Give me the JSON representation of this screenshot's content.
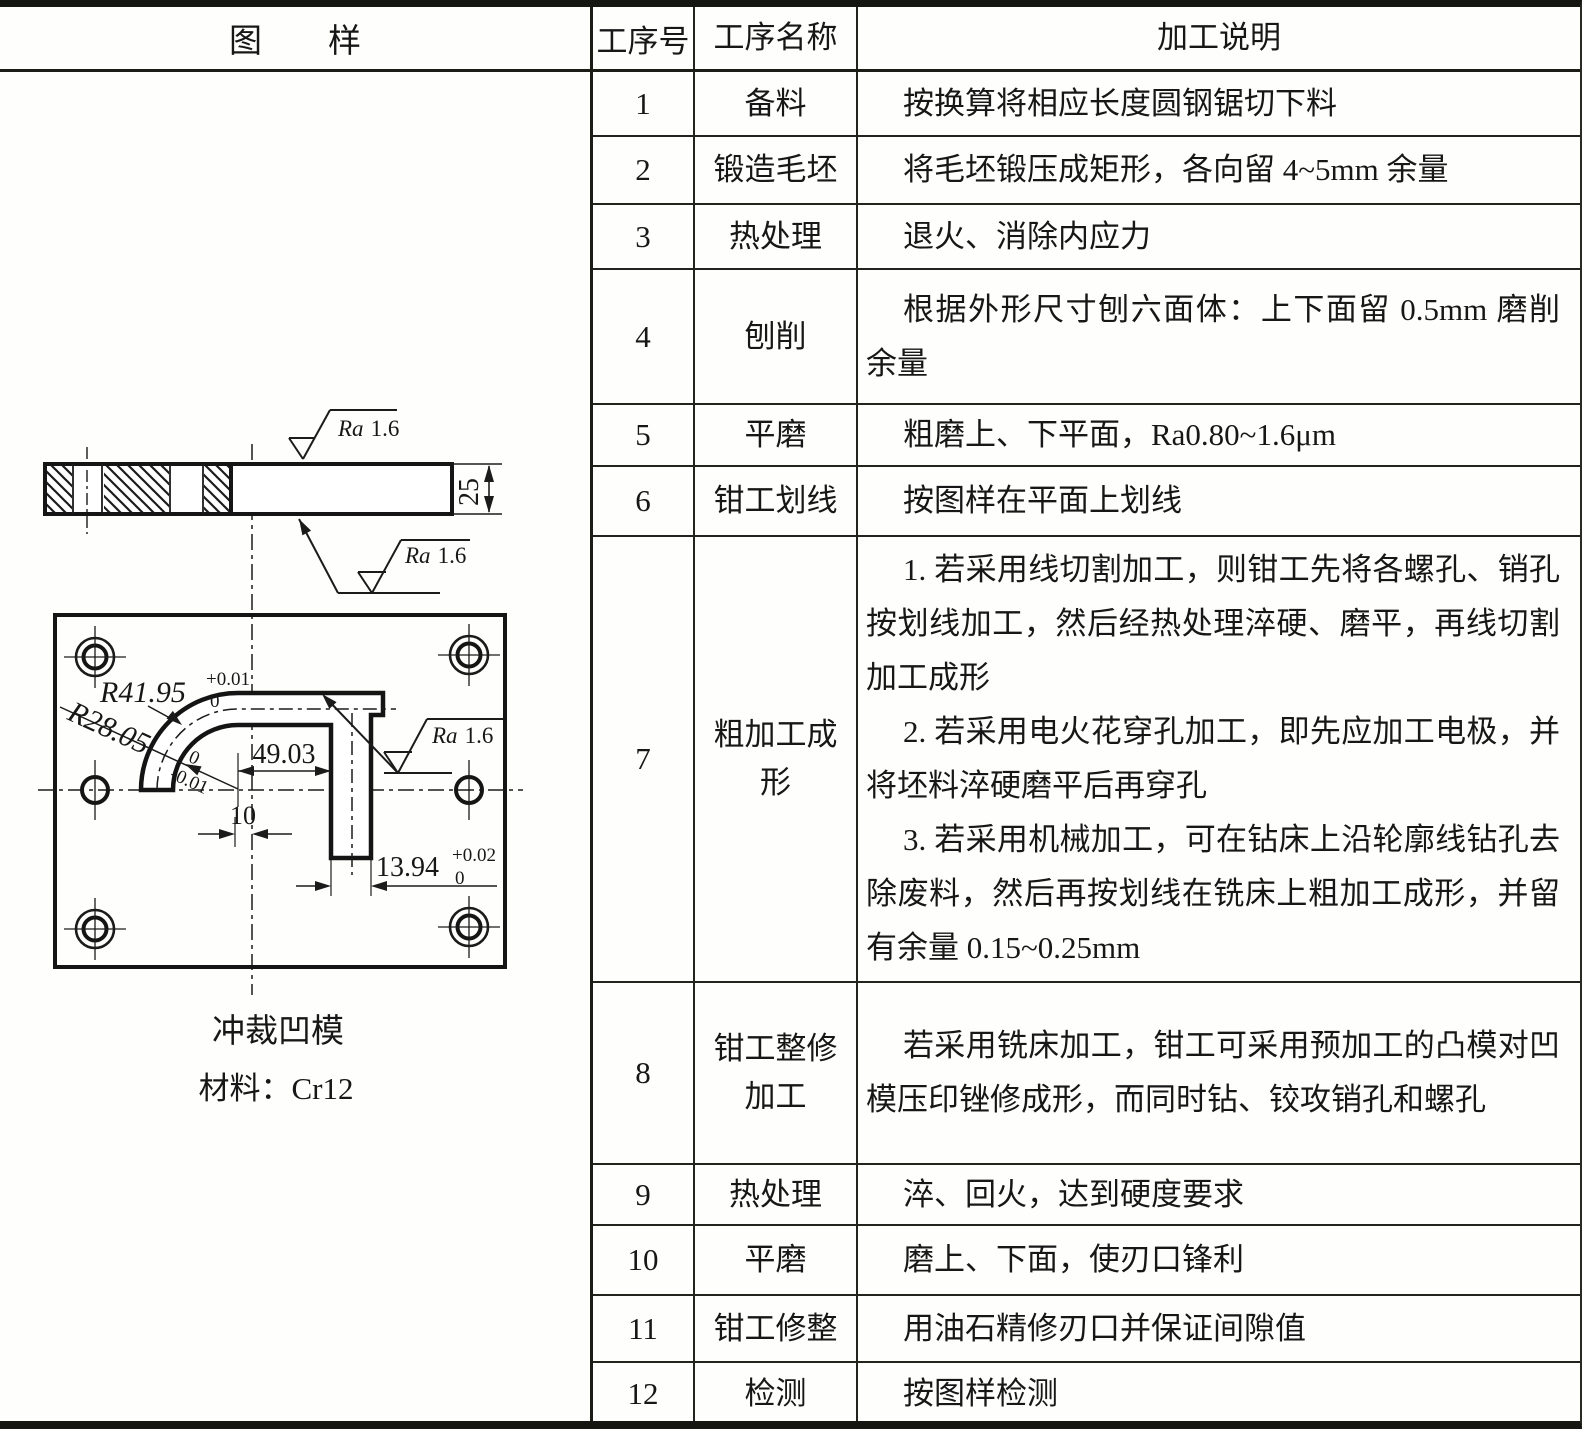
{
  "table": {
    "headers": {
      "sample": "图样",
      "no": "工序号",
      "name": "工序名称",
      "desc": "加工说明"
    },
    "rows": [
      {
        "no": "1",
        "name": "备料",
        "desc": [
          "按换算将相应长度圆钢锯切下料"
        ]
      },
      {
        "no": "2",
        "name": "锻造毛坯",
        "desc": [
          "将毛坯锻压成矩形，各向留 4~5mm 余量"
        ]
      },
      {
        "no": "3",
        "name": "热处理",
        "desc": [
          "退火、消除内应力"
        ]
      },
      {
        "no": "4",
        "name": "刨削",
        "desc": [
          "根据外形尺寸刨六面体：上下面留 0.5mm 磨削余量"
        ]
      },
      {
        "no": "5",
        "name": "平磨",
        "desc": [
          "粗磨上、下平面，Ra0.80~1.6μm"
        ]
      },
      {
        "no": "6",
        "name": "钳工划线",
        "desc": [
          "按图样在平面上划线"
        ]
      },
      {
        "no": "7",
        "name": "粗加工成形",
        "desc": [
          "1. 若采用线切割加工，则钳工先将各螺孔、销孔按划线加工，然后经热处理淬硬、磨平，再线切割加工成形",
          "2. 若采用电火花穿孔加工，即先应加工电极，并将坯料淬硬磨平后再穿孔",
          "3. 若采用机械加工，可在钻床上沿轮廓线钻孔去除废料，然后再按划线在铣床上粗加工成形，并留有余量 0.15~0.25mm"
        ]
      },
      {
        "no": "8",
        "name": "钳工整修\n加工",
        "desc": [
          "若采用铣床加工，钳工可采用预加工的凸模对凹模压印锉修成形，而同时钻、铰攻销孔和螺孔"
        ]
      },
      {
        "no": "9",
        "name": "热处理",
        "desc": [
          "淬、回火，达到硬度要求"
        ]
      },
      {
        "no": "10",
        "name": "平磨",
        "desc": [
          "磨上、下面，使刃口锋利"
        ]
      },
      {
        "no": "11",
        "name": "钳工修整",
        "desc": [
          "用油石精修刃口并保证间隙值"
        ]
      },
      {
        "no": "12",
        "name": "检测",
        "desc": [
          "按图样检测"
        ]
      }
    ]
  },
  "drawing": {
    "caption_title": "冲裁凹模",
    "caption_material": "材料：Cr12",
    "dims": {
      "ra_label": "Ra",
      "ra_value": "1.6",
      "thickness": "25",
      "r_outer": "R41.95",
      "r_outer_tol_up": "+0.01",
      "r_outer_tol_dn": "0",
      "r_inner": "R28.05",
      "r_inner_tol_up": "0",
      "r_inner_tol_dn": "-0.01",
      "width": "49.03",
      "offset": "10",
      "slot": "13.94",
      "slot_tol_up": "+0.02",
      "slot_tol_dn": "0"
    }
  }
}
